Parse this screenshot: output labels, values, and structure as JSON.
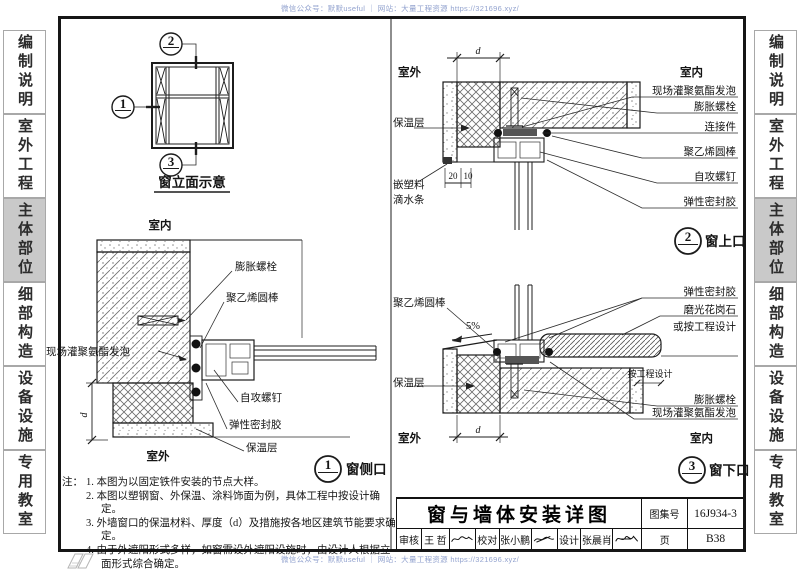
{
  "watermark": {
    "top": "微信公众号：默默useful ｜ 网站：大量工程资源 https://321696.xyz/",
    "bottom": "微信公众号：默默useful ｜ 网站：大量工程资源 https://321696.xyz/"
  },
  "sidebar": {
    "items": [
      {
        "label": "编制说明",
        "active": false
      },
      {
        "label": "室外工程",
        "active": false
      },
      {
        "label": "主体部位",
        "active": true
      },
      {
        "label": "细部构造",
        "active": false
      },
      {
        "label": "设备设施",
        "active": false
      },
      {
        "label": "专用教室",
        "active": false
      }
    ]
  },
  "elevation": {
    "title": "窗立面示意",
    "callout_top": "2",
    "callout_left": "1",
    "callout_bottom": "3"
  },
  "detail_side": {
    "number": "1",
    "name": "窗侧口",
    "room_in": "室内",
    "room_out": "室外",
    "dim": "d",
    "labels": {
      "anchor": "膨胀螺栓",
      "rod": "聚乙烯圆棒",
      "foam": "现场灌聚氨酯发泡",
      "screw": "自攻螺钉",
      "sealant": "弹性密封胶",
      "insulation": "保温层"
    }
  },
  "detail_top": {
    "number": "2",
    "name": "窗上口",
    "room_out": "室外",
    "room_in": "室内",
    "dim": "d",
    "dim20": "20",
    "dim10": "10",
    "labels": {
      "insulation": "保温层",
      "drip1": "嵌塑料",
      "drip2": "滴水条",
      "foam": "现场灌聚氨酯发泡",
      "anchor": "膨胀螺栓",
      "connector": "连接件",
      "rod": "聚乙烯圆棒",
      "screw": "自攻螺钉",
      "sealant": "弹性密封胶"
    }
  },
  "detail_bottom": {
    "number": "3",
    "name": "窗下口",
    "room_out": "室外",
    "room_in": "室内",
    "dim": "d",
    "slope": "5%",
    "labels": {
      "rod": "聚乙烯圆棒",
      "sealant": "弹性密封胶",
      "granite": "磨光花岗石",
      "granite2": "或按工程设计",
      "by_design": "按工程设计",
      "insulation": "保温层",
      "anchor": "膨胀螺栓",
      "foam": "现场灌聚氨酯发泡"
    }
  },
  "notes": {
    "prefix": "注：",
    "items": [
      "1. 本图为以固定铁件安装的节点大样。",
      "2. 本图以塑钢窗、外保温、涂料饰面为例，具体工程中按设计确定。",
      "3. 外墙窗口的保温材料、厚度（d）及措施按各地区建筑节能要求确定。",
      "4. 由于外遮阳形式多样，如窗需设外遮阳设施时，由设计人根据立面形式综合确定。"
    ]
  },
  "titleblock": {
    "title": "窗与墙体安装详图",
    "atlas_label": "图集号",
    "atlas_no": "16J934-3",
    "page_label": "页",
    "page_no": "B38",
    "review_label": "审核",
    "reviewer": "王 哲",
    "proof_label": "校对",
    "proofer": "张小鹏",
    "design_label": "设计",
    "designer": "张晨肖"
  }
}
